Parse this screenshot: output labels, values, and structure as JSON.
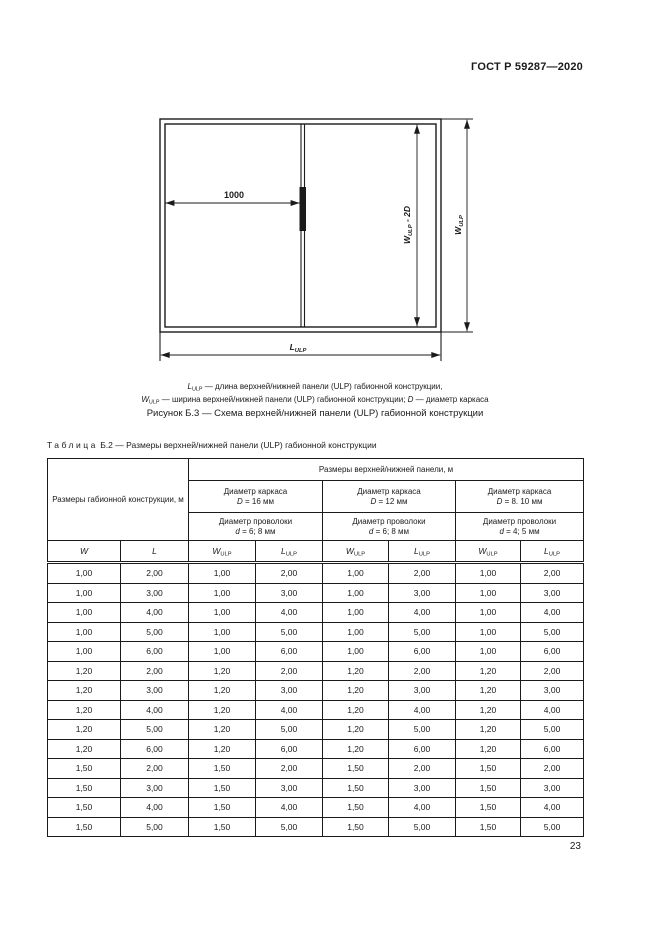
{
  "page": {
    "doc_number": "ГОСТ Р 59287—2020",
    "page_number": "23"
  },
  "figure": {
    "dim_1000": "1000",
    "w_sym": "W",
    "l_sym": "L",
    "sub": "ULP",
    "minus_2d": " - 2D",
    "legend": {
      "l1_text": " — длина верхней/нижней панели (ULP) габионной конструкции,",
      "l2_text_a": " — ширина верхней/нижней панели (ULP) габионной конструкции; ",
      "d_sym": "D",
      "l2_text_b": " — диаметр каркаса"
    },
    "title": "Рисунок Б.3 — Схема верхней/нижней панели (ULP) габионной конструкции"
  },
  "table": {
    "title_word": "Таблица",
    "title_rest": " Б.2 — Размеры верхней/нижней панели (ULP) габионной конструкции",
    "head": {
      "left_group": "Размеры габионной конструкции, м",
      "panel_group": "Размеры верхней/нижней панели, м",
      "frame_title": "Диаметр каркаса",
      "frame_sym": "D",
      "frame_vals": [
        " = 16 мм",
        " = 12 мм",
        " = 8. 10 мм"
      ],
      "wire_title": "Диаметр проволоки",
      "wire_sym": "d",
      "wire_vals": [
        " = 6; 8 мм",
        " = 6; 8 мм",
        " = 4; 5 мм"
      ],
      "col_w": "W",
      "col_l": "L",
      "sub": "ULP"
    },
    "rows": [
      [
        "1,00",
        "2,00",
        "1,00",
        "2,00",
        "1,00",
        "2,00",
        "1,00",
        "2,00"
      ],
      [
        "1,00",
        "3,00",
        "1,00",
        "3,00",
        "1,00",
        "3,00",
        "1,00",
        "3,00"
      ],
      [
        "1,00",
        "4,00",
        "1,00",
        "4,00",
        "1,00",
        "4,00",
        "1,00",
        "4,00"
      ],
      [
        "1,00",
        "5,00",
        "1,00",
        "5,00",
        "1,00",
        "5,00",
        "1,00",
        "5,00"
      ],
      [
        "1,00",
        "6,00",
        "1,00",
        "6,00",
        "1,00",
        "6,00",
        "1,00",
        "6,00"
      ],
      [
        "1,20",
        "2,00",
        "1,20",
        "2,00",
        "1,20",
        "2,00",
        "1,20",
        "2,00"
      ],
      [
        "1,20",
        "3,00",
        "1,20",
        "3,00",
        "1,20",
        "3,00",
        "1,20",
        "3,00"
      ],
      [
        "1,20",
        "4,00",
        "1,20",
        "4,00",
        "1,20",
        "4,00",
        "1,20",
        "4,00"
      ],
      [
        "1,20",
        "5,00",
        "1,20",
        "5,00",
        "1,20",
        "5,00",
        "1,20",
        "5,00"
      ],
      [
        "1,20",
        "6,00",
        "1,20",
        "6,00",
        "1,20",
        "6,00",
        "1,20",
        "6,00"
      ],
      [
        "1,50",
        "2,00",
        "1,50",
        "2,00",
        "1,50",
        "2,00",
        "1,50",
        "2,00"
      ],
      [
        "1,50",
        "3,00",
        "1,50",
        "3,00",
        "1,50",
        "3,00",
        "1,50",
        "3,00"
      ],
      [
        "1,50",
        "4,00",
        "1,50",
        "4,00",
        "1,50",
        "4,00",
        "1,50",
        "4,00"
      ],
      [
        "1,50",
        "5,00",
        "1,50",
        "5,00",
        "1,50",
        "5,00",
        "1,50",
        "5,00"
      ]
    ]
  }
}
